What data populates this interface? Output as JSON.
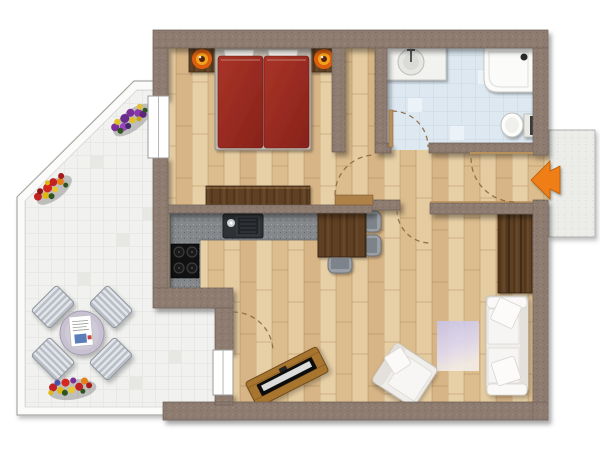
{
  "plan": {
    "type": "apartment-floorplan-top-view",
    "rooms": [
      {
        "id": "bedroom",
        "furniture": [
          "double-bed",
          "nightstand-left",
          "nightstand-right",
          "lamp-left",
          "lamp-right",
          "dresser"
        ]
      },
      {
        "id": "bathroom",
        "furniture": [
          "sink-vanity",
          "shower",
          "toilet"
        ]
      },
      {
        "id": "kitchen",
        "furniture": [
          "l-shaped-counter",
          "kitchen-sink",
          "cooktop",
          "dining-table",
          "dining-chairs-x3"
        ]
      },
      {
        "id": "living-room",
        "furniture": [
          "sofa",
          "armchair",
          "rug",
          "tv-lowboard",
          "wardrobe"
        ]
      },
      {
        "id": "hallway",
        "furniture": []
      },
      {
        "id": "terrace",
        "furniture": [
          "round-table",
          "terrace-chairs-x4",
          "magazine",
          "flower-bed-x3"
        ]
      },
      {
        "id": "entrance",
        "furniture": [
          "entry-arrow",
          "stair-landing"
        ]
      }
    ],
    "door_arcs": 5,
    "windows": [
      "bedroom-window-left",
      "terrace-door"
    ]
  },
  "palette": {
    "wall": "#8e7c71",
    "wall_edge": "#6e5f55",
    "wood_floor": "#e3c79c",
    "dark_wood": "#5f3f22",
    "mid_wood": "#a8742f",
    "bath_tile": "#dde8f1",
    "terrace_tile": "#f1f1ef",
    "counter": "#84888b",
    "cooktop": "#111111",
    "bed_red": "#9c2b21",
    "sofa_white": "#f1efec",
    "rug_lavender": "#cfc8e6",
    "arrow_orange": "#ef7e16",
    "landing": "#ecece9",
    "door_arc": "#8a6a42",
    "window_white": "#ffffff",
    "lamp_orange": "#f2a31d"
  }
}
